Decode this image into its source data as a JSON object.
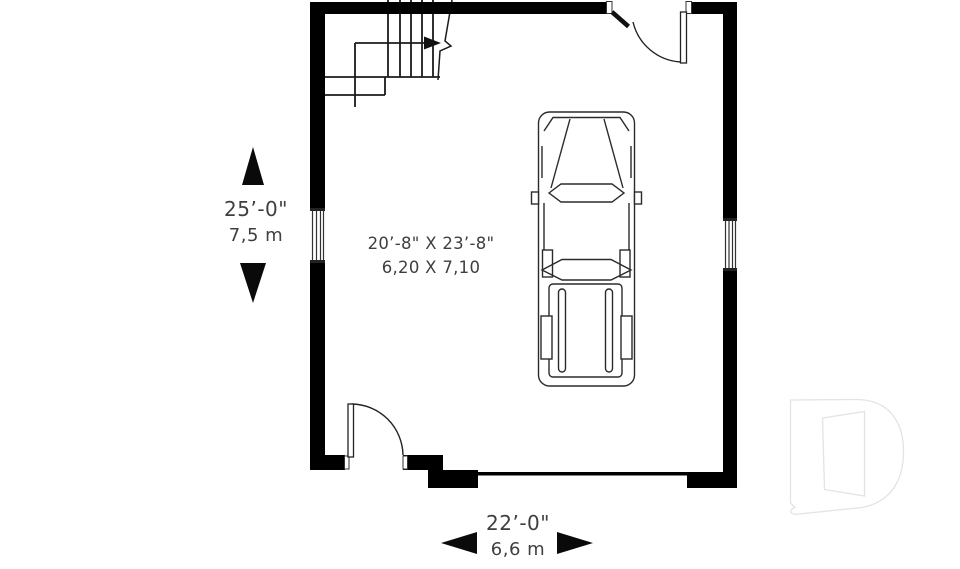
{
  "floor_plan": {
    "room_label": {
      "imperial": "20’-8\" X 23’-8\"",
      "metric": "6,20 X 7,10"
    },
    "depth_dimension": {
      "imperial": "25’-0\"",
      "metric": "7,5 m"
    },
    "width_dimension": {
      "imperial": "22’-0\"",
      "metric": "6,6 m"
    },
    "colors": {
      "walls": "#000000",
      "linework": "#2b2b2b",
      "text": "#3f3f3f",
      "logo_watermark": "#e3e3e3",
      "background": "#ffffff"
    },
    "symbols": {
      "staircase": "stair-treads-with-up-arrow-and-break-line",
      "vehicle": "pickup-truck-top-view",
      "doors": [
        "swing-door-top",
        "swing-door-bottom-left"
      ],
      "windows": [
        "left-wall-window",
        "right-wall-window"
      ],
      "garage_door": "wide-opening-in-bottom-wall",
      "dimension_arrows": [
        "up",
        "down",
        "left",
        "right"
      ],
      "logo": "letter-d-open-door-watermark"
    }
  }
}
